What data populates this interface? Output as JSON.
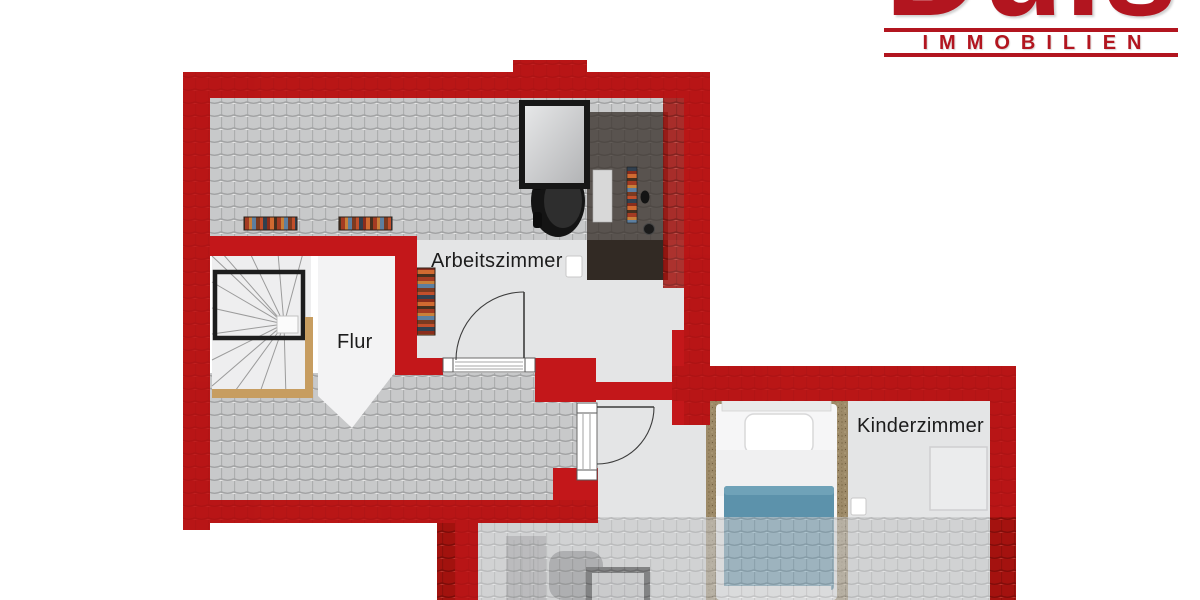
{
  "logo": {
    "brand": "Duis",
    "subtitle": "IMMOBILIEN"
  },
  "floor_plan": {
    "labels": {
      "study": "Arbeitszimmer",
      "hallway": "Flur",
      "childrens_room": "Kinderzimmer"
    },
    "furniture": [
      "winder-staircase",
      "bookshelves",
      "desk",
      "office-chair",
      "skylight-window",
      "single-bed",
      "carpet-runner",
      "sideboard",
      "armchair",
      "wardrobe"
    ],
    "door_count": 2,
    "skylight_count": 2
  },
  "colors": {
    "logo_red": "#b2151f",
    "wall_red": "#c3171a",
    "roof_red_tile": "#a2120e",
    "roof_gray_tile": "#c8c9ca",
    "floor_light": "#e4e5e6",
    "hall_white": "#f3f3f4",
    "blanket_blue": "#5c92ab",
    "carpet_brown": "#9d8a68",
    "stair_wood": "#c79d60",
    "desk_dark": "#322a24"
  }
}
